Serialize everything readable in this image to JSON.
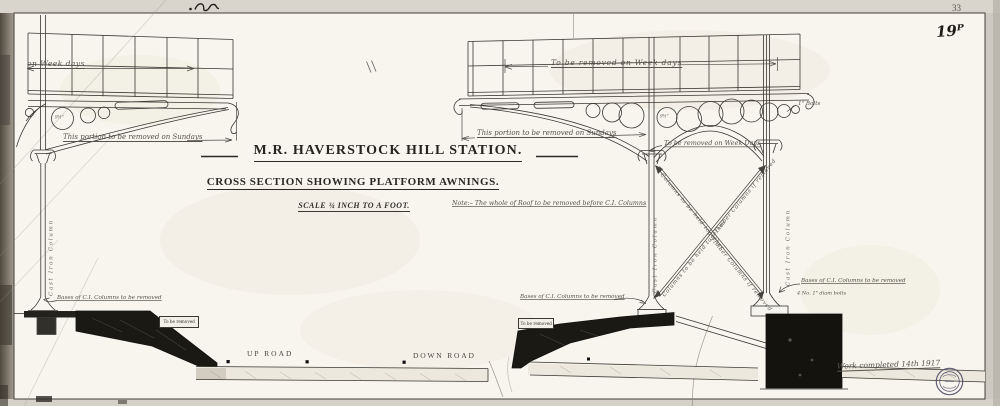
{
  "sheet": {
    "page_number": "33",
    "plate_number": "19ᴾ",
    "completion_note": "Work completed 14th 1917"
  },
  "title_block": {
    "title": "M.R. HAVERSTOCK HILL STATION.",
    "subtitle": "CROSS SECTION SHOWING PLATFORM AWNINGS.",
    "scale_note": "SCALE ¾ INCH TO A FOOT.",
    "roof_note": "Note:– The whole of Roof to be removed before C.I. Columns"
  },
  "left_awning": {
    "weekdays_dim": "on Week days",
    "sundays_note": "This portion to be removed on Sundays",
    "circle_dim": "9½\"",
    "column_label": "Cast Iron Column",
    "base_note": "Bases of C.I. Columns to be removed"
  },
  "right_awning": {
    "weekdays_dim": "To be removed on Week days",
    "sundays_note": "This portion to be removed on Sundays",
    "mid_weekdays_note": "To be removed on Week Days",
    "circle_dim": "9½\"",
    "mid_column_label": "Cast Iron Column",
    "right_column_label": "Cast Iron Column",
    "bolts_label": "1\" Bolts",
    "brace_note_1": "Columns to be held together",
    "brace_note_2": "Timber Columns if removed",
    "brace_note_3": "Columns to be held together",
    "brace_note_4": "Timber Columns if removed",
    "mid_base_note": "Bases of C.I. Columns to be removed",
    "right_base_note": "Bases of C.I. Columns to be removed",
    "right_base_bolts": "4 No. 1\" diam bolts"
  },
  "ground": {
    "up_road_label": "UP ROAD",
    "down_road_label": "DOWN ROAD",
    "left_wall_tag": "To be removed",
    "center_wall_tag": "To be removed"
  },
  "colors": {
    "paper": "#f7f5ee",
    "margin": "#d9d5cc",
    "ink": "#3a3833",
    "black_fill": "#1b1914",
    "stamp_ink": "#4a4663"
  }
}
